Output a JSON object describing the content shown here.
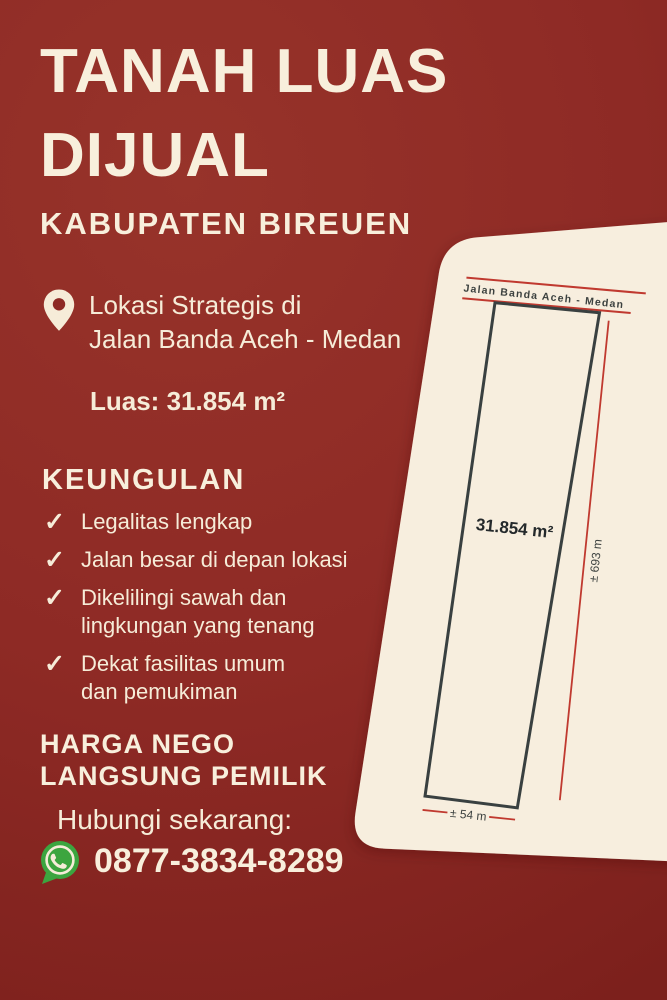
{
  "poster": {
    "title": {
      "line1": "TANAH LUAS",
      "line2": "DIJUAL"
    },
    "subtitle": "KABUPATEN BIREUEN",
    "location": "Lokasi Strategis di\nJalan Banda Aceh - Medan",
    "area": "Luas: 31.854 m²",
    "advantages": {
      "heading": "KEUNGULAN",
      "items": [
        "Legalitas lengkap",
        "Jalan besar di depan lokasi",
        "Dikelilingi sawah dan\nlingkungan yang tenang",
        "Dekat fasilitas umum\ndan pemukiman"
      ]
    },
    "price": "HARGA NEGO\nLANGSUNG PEMILIK",
    "cta": "Hubungi sekarang:",
    "phone": "0877-3834-8289",
    "icons": {
      "check_glyph": "✓",
      "pin": "location-pin-icon",
      "whatsapp": "whatsapp-icon"
    },
    "diagram": {
      "road_label": "Jalan Banda Aceh - Medan",
      "area_label": "31.854 m²",
      "length_label": "± 693 m",
      "width_label": "± 54 m"
    },
    "colors": {
      "background_red": "#8e2a25",
      "cream_text": "#f6ecd8",
      "card_cream": "#f7eede",
      "diagram_red": "#c0392f",
      "plot_stroke": "#394040",
      "whatsapp_green": "#3ca53f"
    }
  }
}
